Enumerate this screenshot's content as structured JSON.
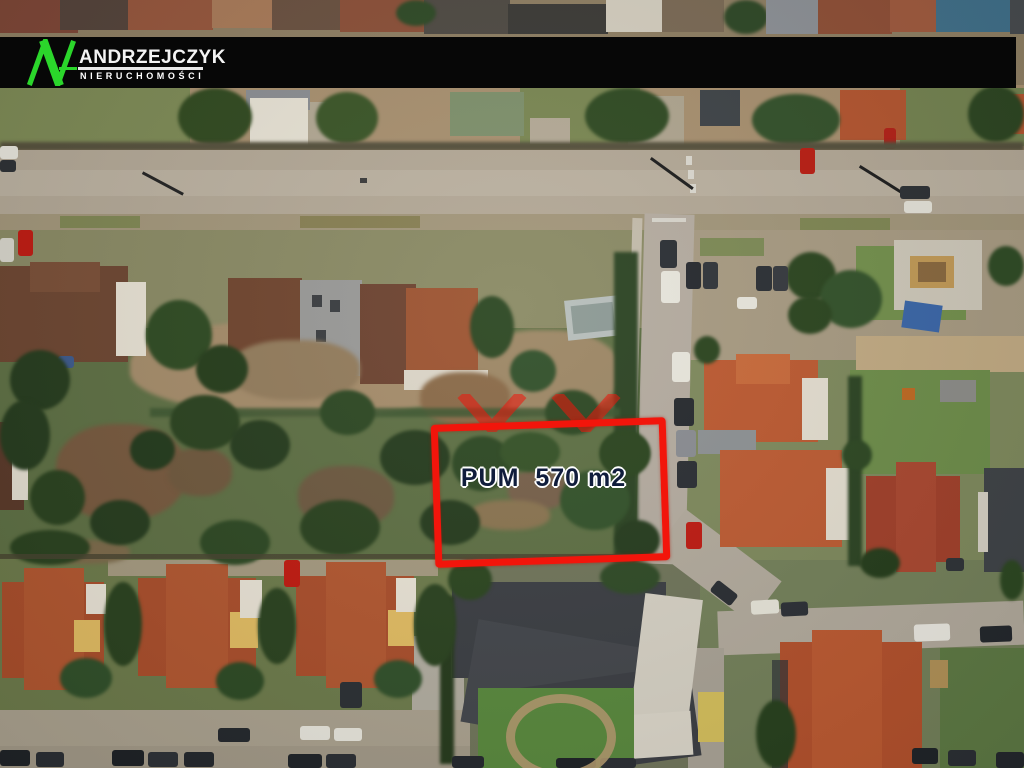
{
  "banner": {
    "company_name": "ANDRZEJCZYK",
    "company_subtitle": "NIERUCHOMOŚCI",
    "background_color": "#070707",
    "logo_color": "#2bd62b",
    "text_color": "#f4f4f4"
  },
  "plot_overlay": {
    "label": "PUM  570 m2",
    "outline_color": "#f2150b",
    "label_color": "#101d3c",
    "watermark_color": "#e01808"
  }
}
